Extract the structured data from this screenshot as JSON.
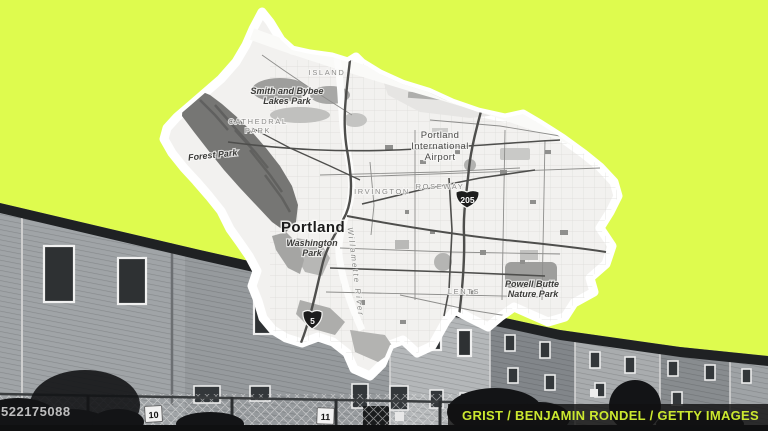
{
  "scene": {
    "background_color": "#defb4e",
    "credit": "GRIST / BENJAMIN RONDEL / GETTY IMAGES",
    "watermark": "522175088"
  },
  "photo": {
    "fence_sign_1": "10",
    "fence_sign_2": "11"
  },
  "map": {
    "labels": {
      "island": "ISLAND",
      "smith_bybee_1": "Smith and Bybee",
      "smith_bybee_2": "Lakes Park",
      "cathedral_1": "CATHEDRAL",
      "cathedral_2": "PARK",
      "forest_park": "Forest Park",
      "airport_1": "Portland",
      "airport_2": "International",
      "airport_3": "Airport",
      "irvington": "IRVINGTON",
      "roseway": "ROSEWAY",
      "portland": "Portland",
      "washington_1": "Washington",
      "washington_2": "Park",
      "river": "Willamette River",
      "lents": "LENTS",
      "powell_1": "Powell Butte",
      "powell_2": "Nature Park",
      "shield_205": "205",
      "shield_5": "5"
    }
  }
}
